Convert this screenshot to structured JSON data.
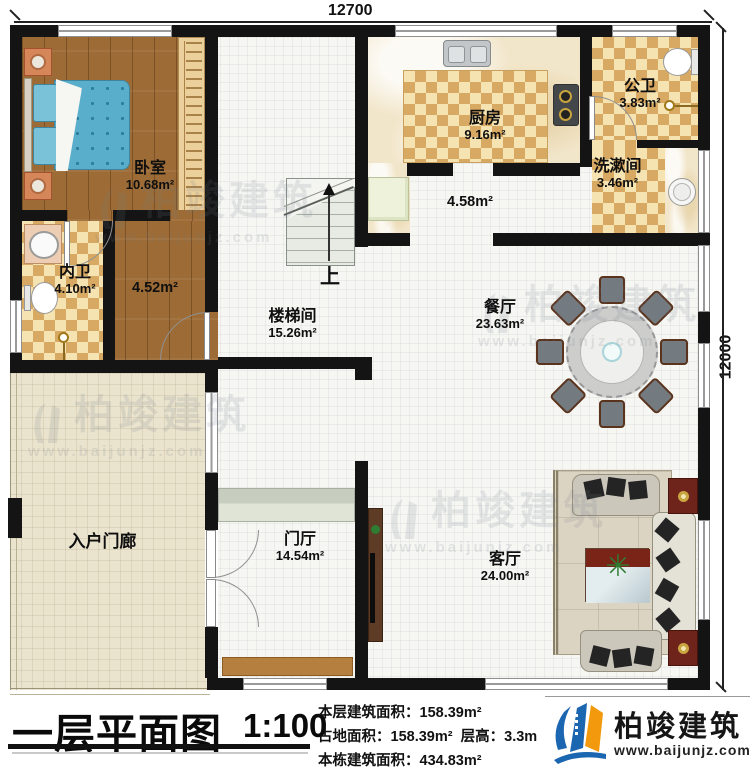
{
  "dimensions": {
    "top": "12700",
    "right": "12000"
  },
  "rooms": {
    "bedroom": {
      "name": "卧室",
      "area": "10.68m²"
    },
    "master_bath": {
      "name": "内卫",
      "area": "4.10m²"
    },
    "suite_hall": {
      "area": "4.52m²"
    },
    "stairwell": {
      "name": "楼梯间",
      "area": "15.26m²"
    },
    "kitchen": {
      "name": "厨房",
      "area": "9.16m²"
    },
    "service_hall": {
      "area": "4.58m²"
    },
    "public_bath": {
      "name": "公卫",
      "area": "3.83m²"
    },
    "washroom": {
      "name": "洗漱间",
      "area": "3.46m²"
    },
    "dining": {
      "name": "餐厅",
      "area": "23.63m²"
    },
    "porch": {
      "name": "入户门廊"
    },
    "foyer": {
      "name": "门厅",
      "area": "14.54m²"
    },
    "living": {
      "name": "客厅",
      "area": "24.00m²"
    }
  },
  "stairs": {
    "direction_label": "上"
  },
  "titleblock": {
    "title": "一层平面图",
    "scale": "1:100"
  },
  "stats": {
    "floor_area_label": "本层建筑面积：",
    "floor_area": "158.39m²",
    "land_area_label": "占地面积：",
    "land_area": "158.39m²",
    "height_label": "层高：",
    "height": "3.3m",
    "total_area_label": "本栋建筑面积：",
    "total_area": "434.83m²"
  },
  "brand": {
    "name": "柏竣建筑",
    "url": "www.baijunjz.com"
  },
  "watermark": {
    "text": "柏竣建筑",
    "url": "www.baijunjz.com"
  }
}
